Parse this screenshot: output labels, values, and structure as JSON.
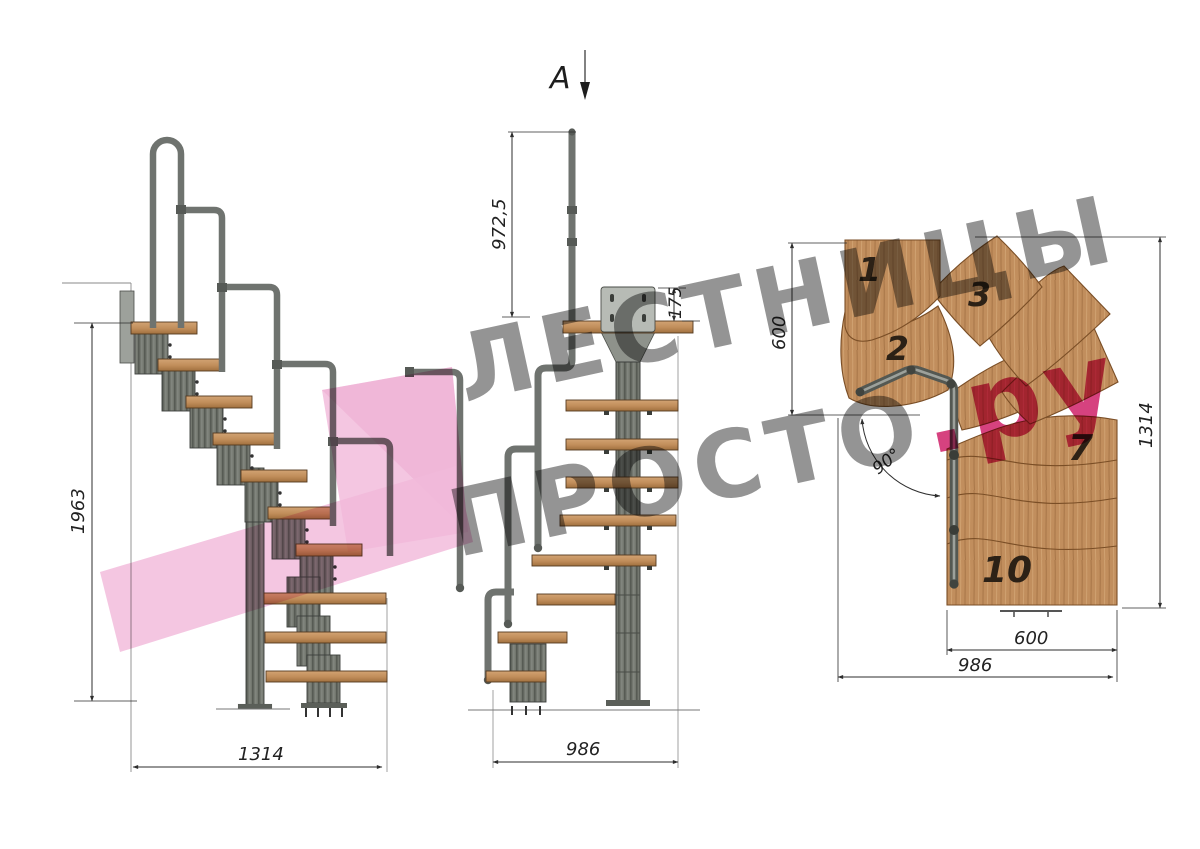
{
  "watermark": {
    "line1": "ЛЕСТНИЦЫ",
    "line2": "ПРОСТО",
    "suffix": ".ру",
    "gray": "#8a8a8a",
    "pink": "#d6427f"
  },
  "section": {
    "label": "A"
  },
  "dimensions": {
    "side_height": "1963",
    "side_width": "1314",
    "front_rail_height": "972,5",
    "front_bracket_height": "175",
    "front_width": "986",
    "plan_turn_depth": "600",
    "plan_length": "1314",
    "plan_tread_width": "600",
    "plan_total_width": "986",
    "plan_angle": "90°"
  },
  "plan_tread_numbers": {
    "t1": "1",
    "t2": "2",
    "t3": "3",
    "t7": "7",
    "t10": "10"
  },
  "colors": {
    "wood": "#c18e5d",
    "wood_dark": "#8a5a32",
    "metal": "#73776f",
    "rail": "#6f736f",
    "line": "#333333",
    "pink_logo": "#f2b9da"
  }
}
